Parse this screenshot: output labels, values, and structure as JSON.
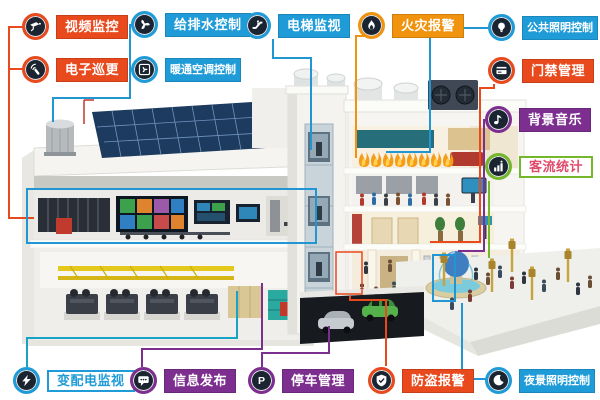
{
  "palette": {
    "orange": "#e8491d",
    "amber_orange": "#f0930f",
    "blue": "#1f9cd8",
    "teal_line": "#17a3c6",
    "purple": "#7c2f8e",
    "green": "#74b62c",
    "pink_text": "#e14b6a",
    "badge_inner": "#1b2531",
    "highlight_box": "#2196d3"
  },
  "systems": [
    {
      "label": "视频监控",
      "icon": "cctv-camera-icon",
      "color": "orange"
    },
    {
      "label": "电子巡更",
      "icon": "patrol-wand-icon",
      "color": "orange"
    },
    {
      "label": "给排水控制",
      "icon": "pump-fan-icon",
      "color": "blue"
    },
    {
      "label": "暖通空调控制",
      "icon": "hvac-fan-icon",
      "color": "blue"
    },
    {
      "label": "电梯监视",
      "icon": "escalator-icon",
      "color": "blue"
    },
    {
      "label": "火灾报警",
      "icon": "flame-icon",
      "color": "amber_orange"
    },
    {
      "label": "公共照明控制",
      "icon": "light-bulb-icon",
      "color": "blue"
    },
    {
      "label": "门禁管理",
      "icon": "access-card-icon",
      "color": "orange"
    },
    {
      "label": "背景音乐",
      "icon": "music-note-icon",
      "color": "purple"
    },
    {
      "label": "客流统计",
      "icon": "people-stats-icon",
      "color": "green",
      "label_style": "white-outline-pink-text"
    },
    {
      "label": "变配电监视",
      "icon": "lightning-bolt-icon",
      "color": "blue",
      "label_style": "white-outline-blue-text"
    },
    {
      "label": "信息发布",
      "icon": "message-bubble-icon",
      "color": "purple"
    },
    {
      "label": "停车管理",
      "icon": "parking-p-icon",
      "color": "purple"
    },
    {
      "label": "防盗报警",
      "icon": "security-shield-icon",
      "color": "orange"
    },
    {
      "label": "夜景照明控制",
      "icon": "moon-icon",
      "color": "blue"
    }
  ]
}
